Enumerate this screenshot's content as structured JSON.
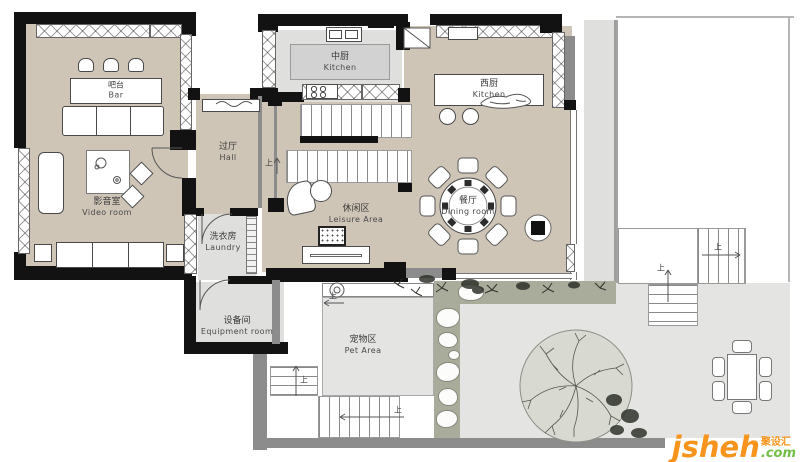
{
  "rooms": {
    "bar": {
      "zh": "吧台",
      "en": "Bar"
    },
    "video": {
      "zh": "影音室",
      "en": "Video room"
    },
    "hall": {
      "zh": "过厅",
      "en": "Hall"
    },
    "laundry": {
      "zh": "洗衣房",
      "en": "Laundry"
    },
    "equipment": {
      "zh": "设备间",
      "en": "Equipment room"
    },
    "kitchen_mid": {
      "zh": "中厨",
      "en": "Kitchen"
    },
    "kitchen_west": {
      "zh": "西厨",
      "en": "Kitchen"
    },
    "dining": {
      "zh": "餐厅",
      "en": "Dining room"
    },
    "leisure": {
      "zh": "休闲区",
      "en": "Leisure Area"
    },
    "pet": {
      "zh": "宠物区",
      "en": "Pet Area"
    }
  },
  "annotations": {
    "up": "上"
  },
  "watermark": {
    "name": "jsheh",
    "tld": ".com",
    "cn": "聚设汇"
  },
  "colors": {
    "floor_indoor": "#cec5b7",
    "floor_service": "#dfdfde",
    "floor_outdoor": "#e4e4e2",
    "garden": "#a9ab9b",
    "wall": "#121212",
    "wall_gray": "#8c8c8c",
    "tree": "#d8d9d1",
    "watermark_orange": "#f7941d",
    "watermark_green": "#72bf44"
  }
}
